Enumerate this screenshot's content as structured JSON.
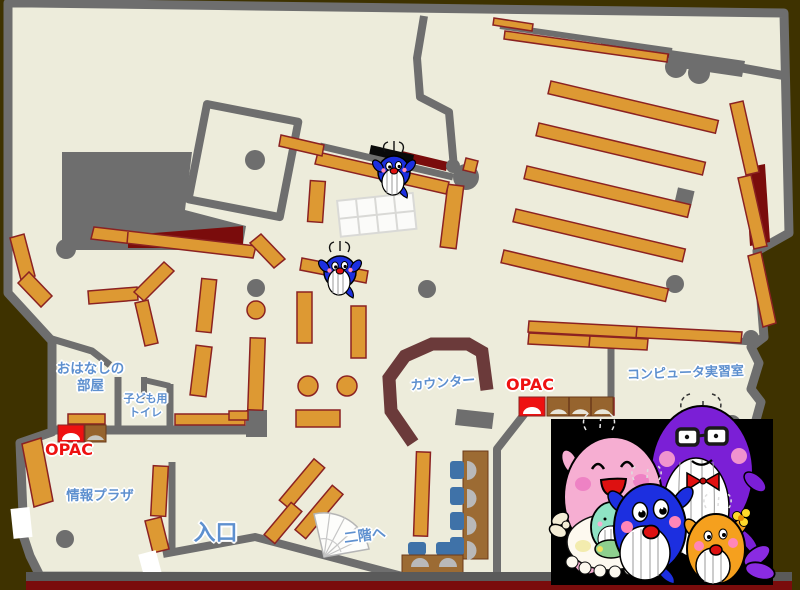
{
  "labels": {
    "story_room": {
      "line1": "おはなしの",
      "line2": "部屋"
    },
    "kids_toilet": {
      "line1": "子ども用",
      "line2": "トイレ"
    },
    "opac_children": "OPAC",
    "info_plaza": "情報プラザ",
    "entrance": "入口",
    "stairs_to_2f": "二階へ",
    "counter": "カウンター",
    "opac_center": "OPAC",
    "computer_room": "コンピュータ実習室"
  },
  "colors": {
    "background": "#3e3200",
    "floor": "#edecdb",
    "wall": "#6e6e6e",
    "shelf_orange": "#dd9933",
    "shelf_border": "#8b2222",
    "stack_backdrop_red": "#7a0c0c",
    "counter_brown": "#6b3a3a",
    "desk_brown": "#9c6b33",
    "chair_blue": "#3f72a8",
    "label_blue": "#5e90cf",
    "label_red": "#ee1111",
    "panel_black": "#000000"
  },
  "mascots": {
    "map_sprite": "blue-whale-mascot",
    "panel_family": [
      "pink-whale-mother",
      "teal-whale-baby",
      "purple-whale-father",
      "blue-whale-child",
      "orange-whale-child"
    ]
  }
}
